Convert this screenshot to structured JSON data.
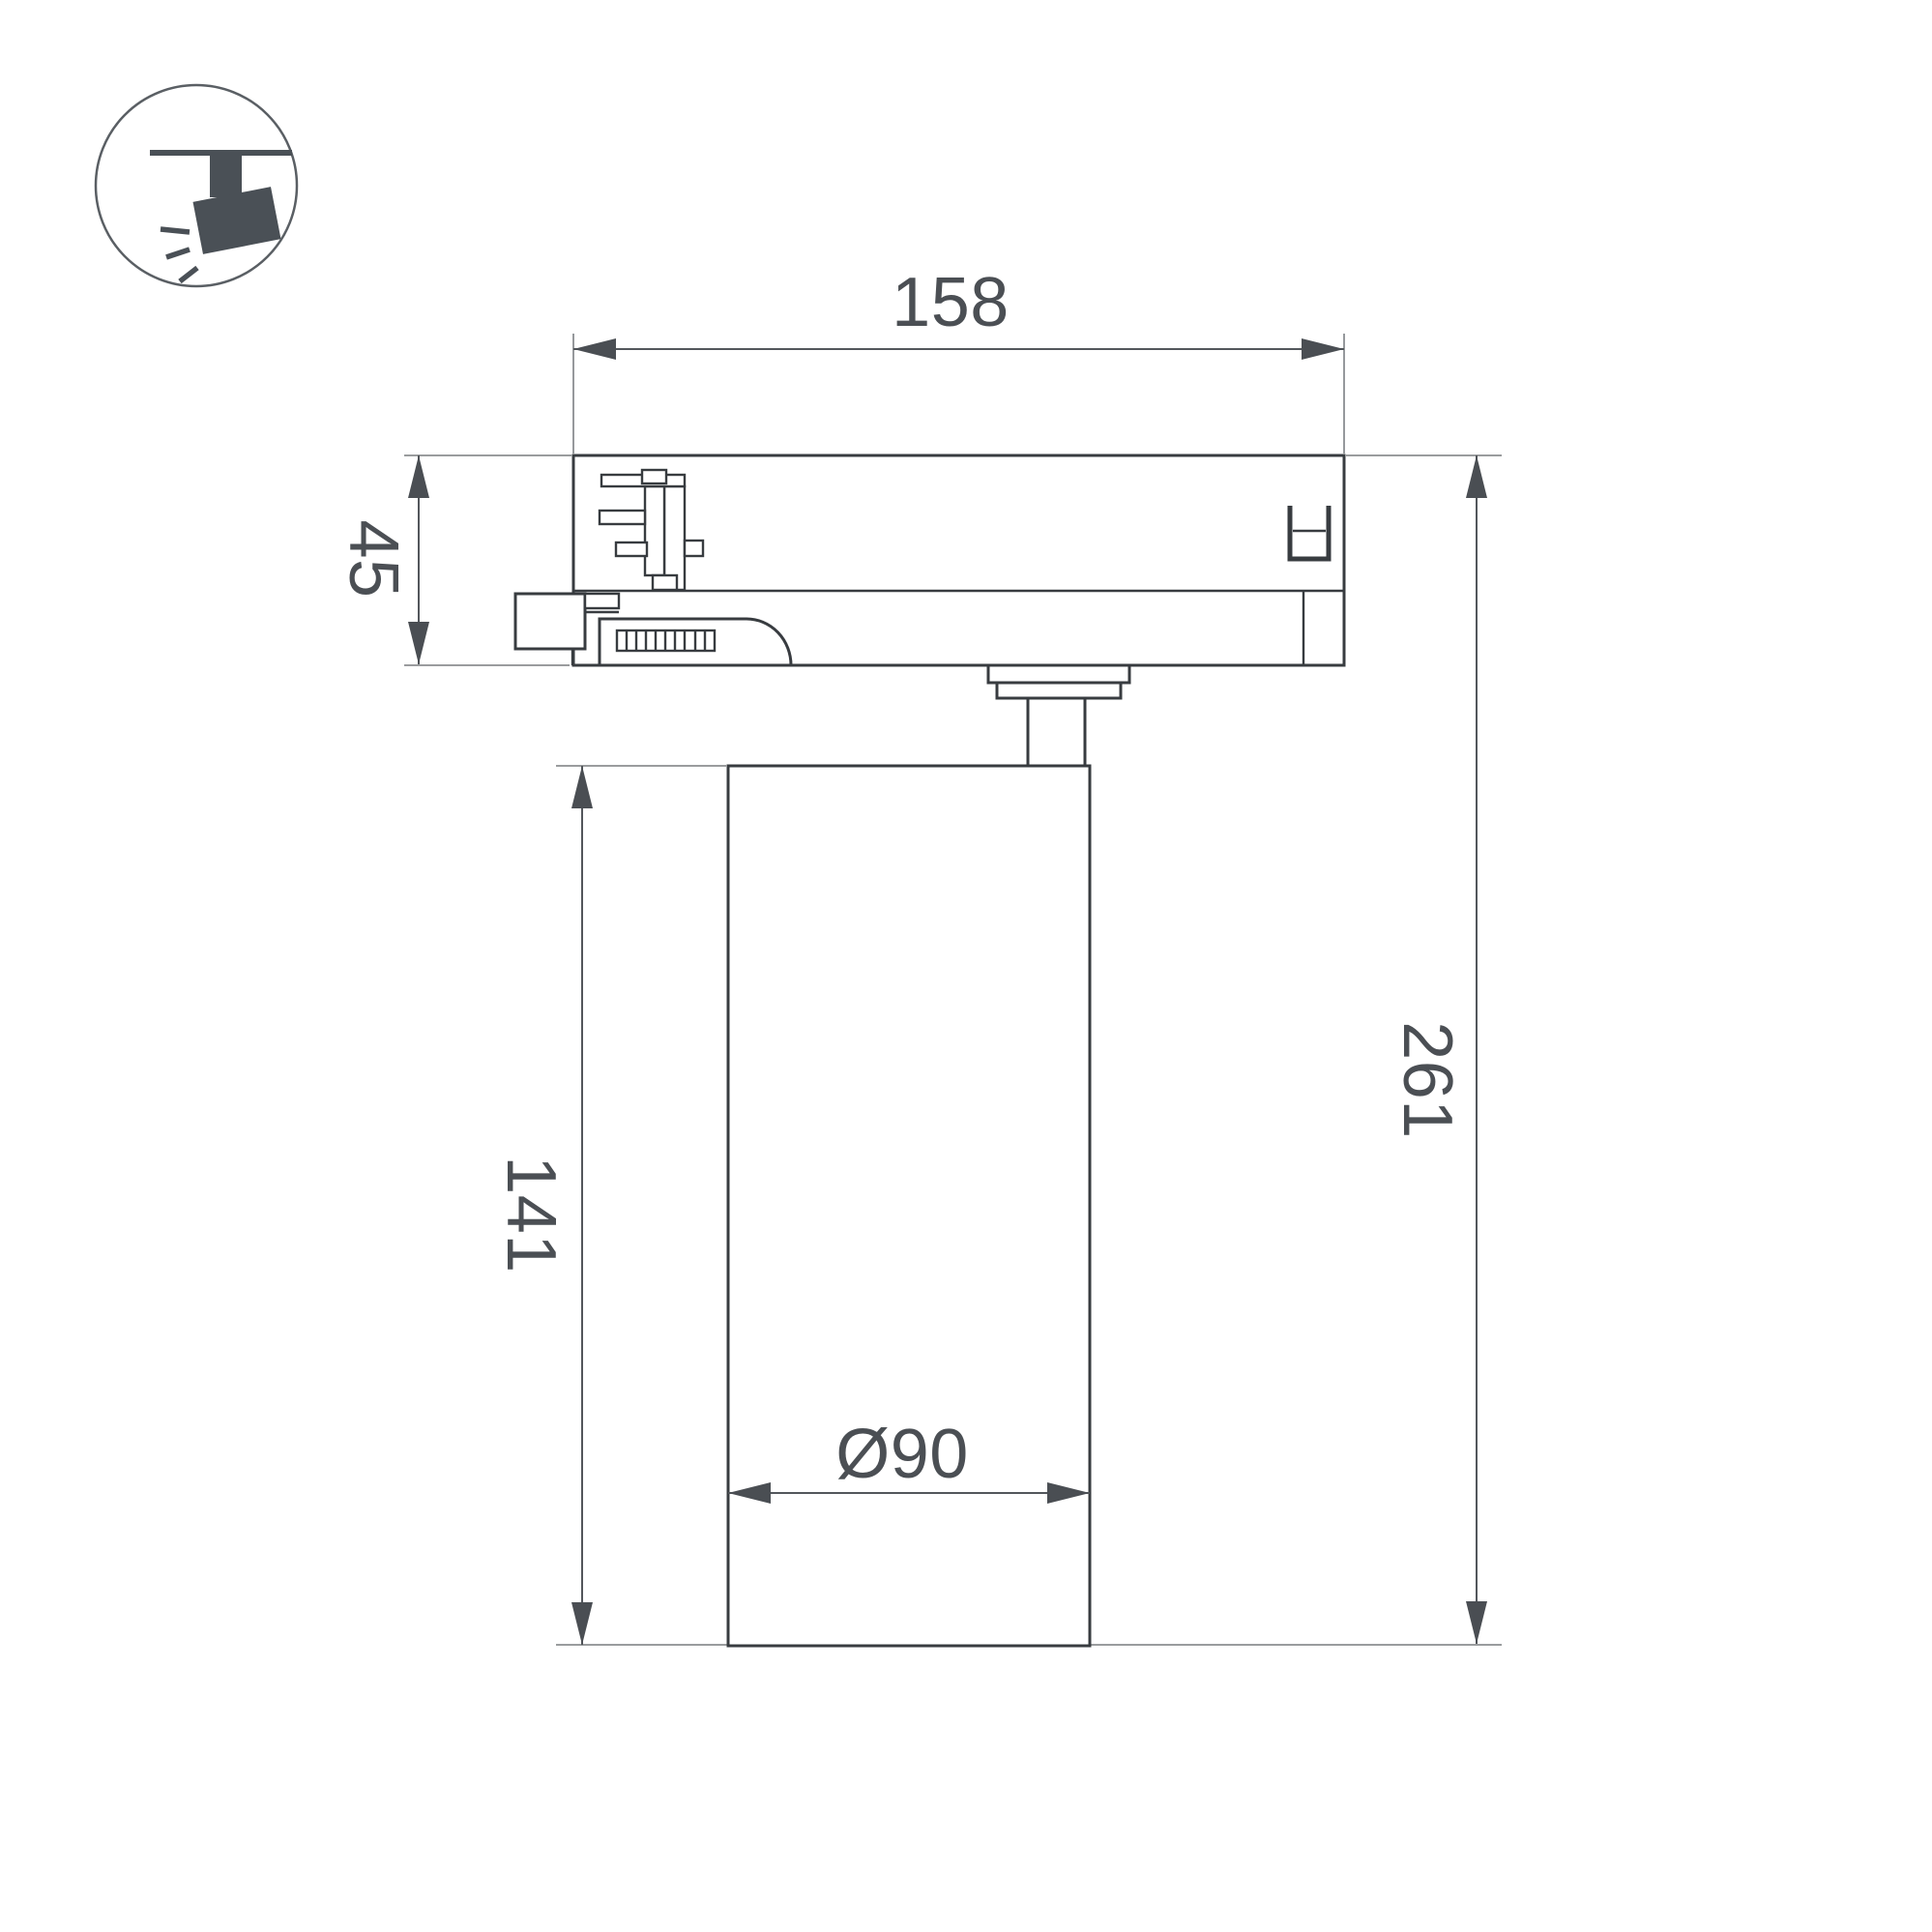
{
  "drawing": {
    "description": "Dimensioned side-view technical drawing of a track-mounted cylindrical spotlight with track adapter",
    "colors": {
      "background": "#ffffff",
      "object_line": "#383c40",
      "dimension_line": "#53575c",
      "extension_line": "#8b8e91",
      "text": "#4b4f54",
      "icon": "#4a5056"
    },
    "dimension_labels": {
      "adapter_width": "158",
      "adapter_height": "45",
      "body_height": "141",
      "total_height": "261",
      "body_diameter": "Ø90"
    },
    "icon": {
      "name": "ceiling-track-spotlight",
      "color": "#4a5056"
    }
  }
}
